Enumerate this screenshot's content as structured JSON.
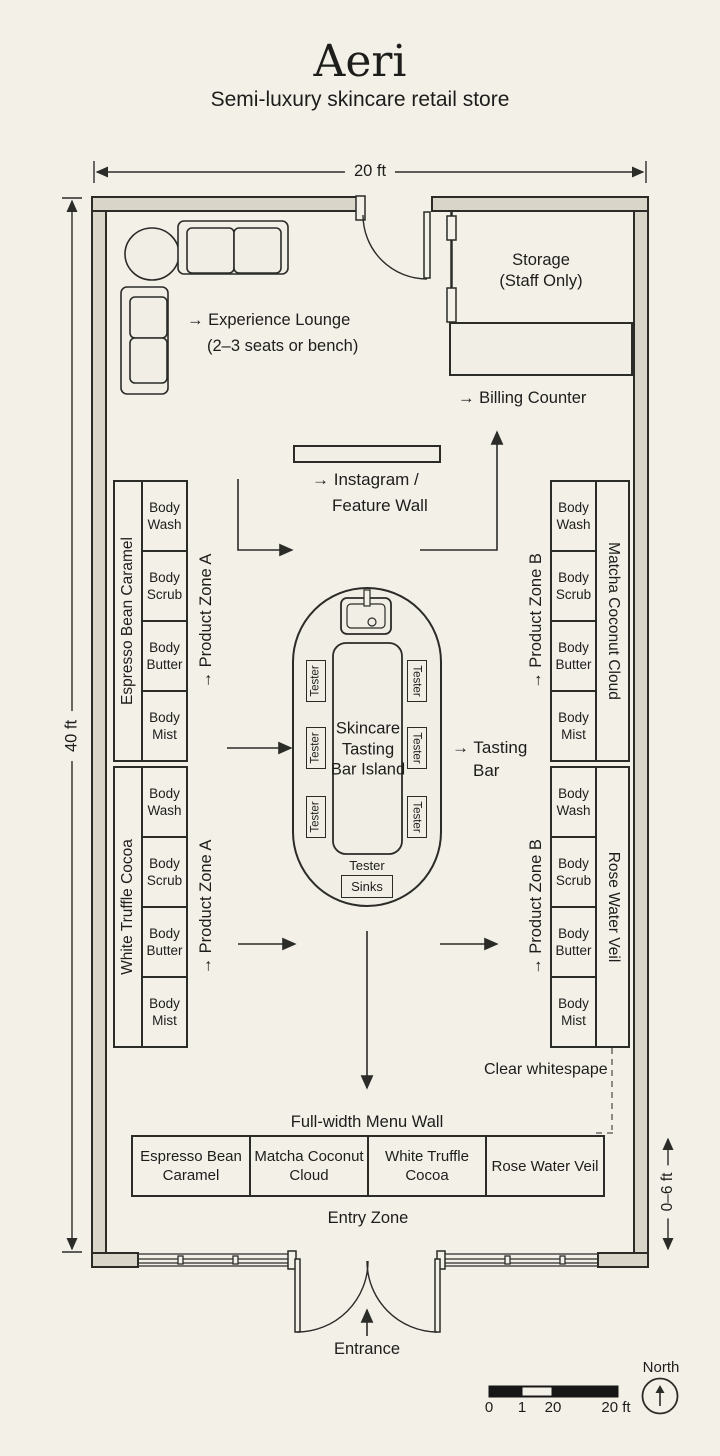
{
  "title": "Aeri",
  "subtitle": "Semi-luxury skincare retail store",
  "dims": {
    "width": "20 ft",
    "height": "40 ft",
    "entry": "0–6 ft"
  },
  "lounge": {
    "line1": "→ Experience Lounge",
    "line2": "(2–3 seats or bench)"
  },
  "storage": {
    "line1": "Storage",
    "line2": "(Staff Only)"
  },
  "billing": {
    "label": "→ Billing Counter"
  },
  "feature_wall": {
    "line1": "→ Instagram /",
    "line2": "Feature Wall"
  },
  "zone_a": "→ Product Zone A",
  "zone_b": "→ Product Zone B",
  "island": {
    "line1": "Skincare",
    "line2": "Tasting",
    "line3": "Bar Island",
    "tester": "Tester",
    "sinks": "Sinks"
  },
  "tasting": {
    "line1": "→ Tasting",
    "line2": "Bar"
  },
  "shelves": {
    "categories": [
      "Body Wash",
      "Body Scrub",
      "Body Butter",
      "Body Mist"
    ],
    "left_brands": [
      "Espresso Bean Caramel",
      "White Truffle Cocoa"
    ],
    "right_brands": [
      "Matcha Coconut Cloud",
      "Rose Water Veil"
    ]
  },
  "whitespace_note": "Clear whitespape",
  "menu": {
    "heading": "Full-width Menu Wall",
    "items": [
      "Espresso Bean Caramel",
      "Matcha Coconut Cloud",
      "White Truffle Cocoa",
      "Rose Water Veil"
    ]
  },
  "entry_zone": "Entry Zone",
  "entrance": "Entrance",
  "scale_bar": {
    "t0": "0",
    "t1": "1",
    "t2": "20",
    "t3": "20 ft"
  },
  "north": "North"
}
